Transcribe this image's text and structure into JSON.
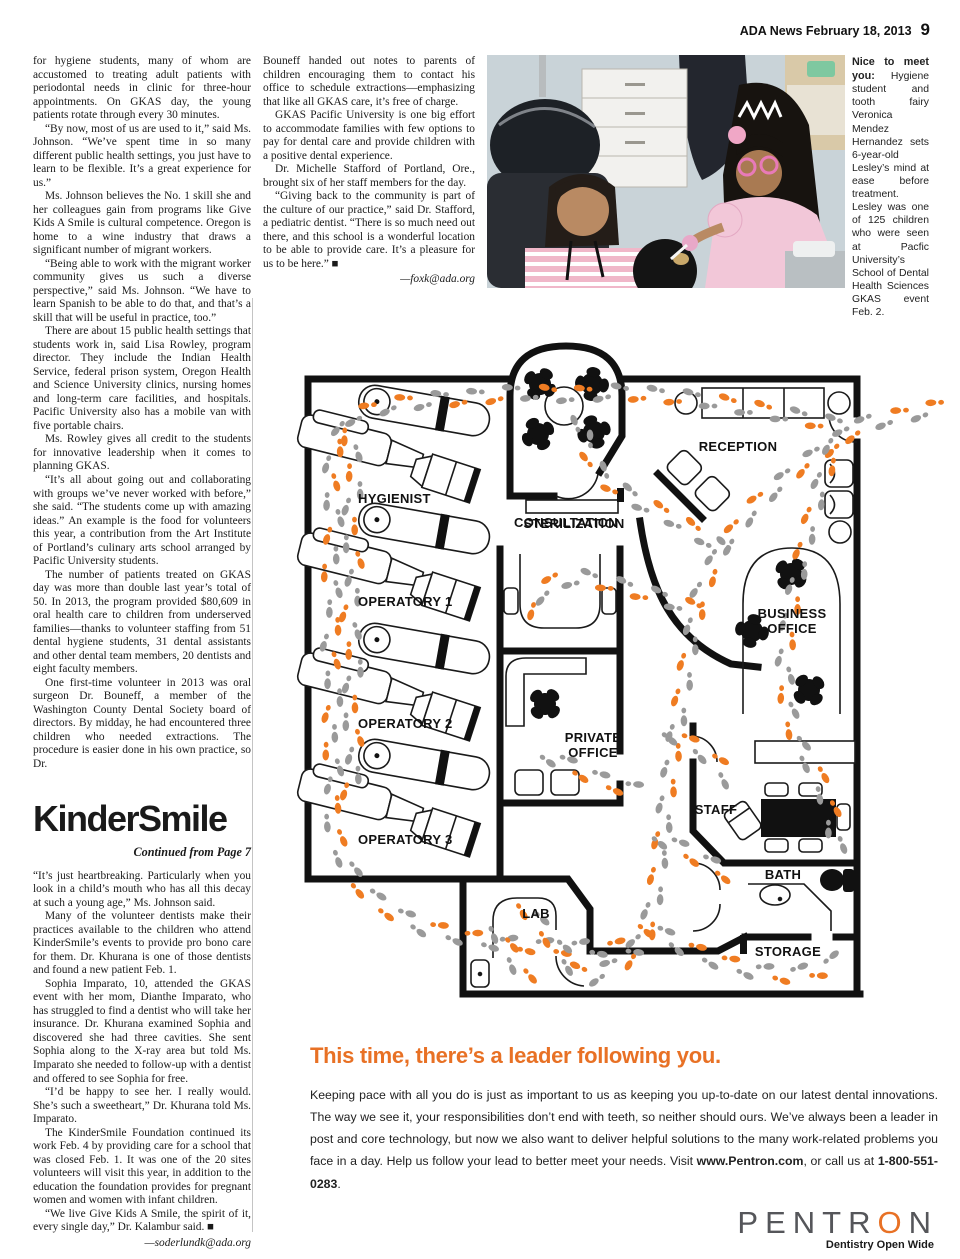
{
  "colors": {
    "accent_orange": "#E87125",
    "foot_orange": "#EF7C22",
    "foot_gray": "#9A9A9A",
    "logo_gray": "#55565A"
  },
  "header": {
    "masthead": "ADA News February 18, 2013",
    "page_number": "9"
  },
  "article": {
    "col1": [
      "for hygiene students, many of whom are accustomed to treating adult patients with periodontal needs in clinic for three-hour appointments. On GKAS day, the young patients rotate through every 30 minutes.",
      "“By now, most of us are used to it,” said Ms. Johnson. “We’ve spent time in so many different public health settings, you just have to learn to be flexible. It’s a great experience for us.”",
      "Ms. Johnson believes the No. 1 skill she and her colleagues gain from programs like Give Kids A Smile is cultural competence. Oregon is home to a wine industry that draws a significant number of migrant workers.",
      "“Being able to work with the migrant worker community gives us such a diverse perspective,” said Ms. Johnson. “We have to learn Spanish to be able to do that, and that’s a skill that will be useful in practice, too.”",
      "There are about 15 public health settings that students work in, said Lisa Rowley, program director. They include the Indian Health Service, federal prison system, Oregon Health and Science University clinics, nursing homes and long-term care facilities, and hospitals. Pacific University also has a mobile van with five portable chairs.",
      "Ms. Rowley gives all credit to the students for innovative leadership when it comes to planning GKAS.",
      "“It’s all about going out and collaborating with groups we’ve never worked with before,” she said. “The students come up with amazing ideas.” An example is the food for volunteers this year, a contribution from the Art Institute of Portland’s culinary arts school arranged by Pacific University students.",
      "The number of patients treated on GKAS day was more than double last year’s total of 50. In 2013, the program provided $80,609 in oral health care to children from underserved families—thanks to volunteer staffing from 51 dental hygiene students, 31 dental assistants and other dental team members, 20 dentists and eight faculty members.",
      "One first-time volunteer in 2013 was oral surgeon Dr. Bouneff, a member of the Washington County Dental Society board of directors. By midday, he had encountered three children who needed extractions. The procedure is easier done in his own practice, so Dr."
    ],
    "col2": [
      "Bouneff handed out notes to parents of children encouraging them to contact his office to schedule extractions—emphasizing that like all GKAS care, it’s free of charge.",
      "GKAS Pacific University is one big effort to accommodate families with few options to pay for dental care and provide children with a positive dental experience.",
      "Dr. Michelle Stafford of Portland, Ore., brought six of her staff members for the day.",
      "“Giving back to the community is part of the culture of our practice,” said Dr. Stafford, a pediatric dentist. “There is so much need out there, and this school is a wonderful location to be able to provide care. It’s a pleasure for us to be here.” ■"
    ],
    "col2_byline": "—foxk@ada.org"
  },
  "kindersmile": {
    "headline": "KinderSmile",
    "continued": "Continued from Page 7",
    "paras": [
      "“It’s just heartbreaking. Particularly when you look in a child’s mouth who has all this decay at such a young age,” Ms. Johnson said.",
      "Many of the volunteer dentists make their practices available to the children who attend KinderSmile’s events to provide pro bono care for them. Dr. Khurana is one of those dentists and found a new patient Feb. 1.",
      "Sophia Imparato, 10, attended the GKAS event with her mom, Dianthe Imparato, who has struggled to find a dentist who will take her insurance. Dr. Khurana examined Sophia and discovered she had three cavities. She sent Sophia along to the X-ray area but told Ms. Imparato she needed to follow-up with a dentist and offered to see Sophia for free.",
      "“I’d be happy to see her. I really would. She’s such a sweetheart,” Dr. Khurana told Ms. Imparato.",
      "The KinderSmile Foundation continued its work Feb. 4 by providing care for a school that was closed Feb. 1. It was one of the 20 sites volunteers will visit this year, in addition to the education the foundation provides for pregnant women and women with infant children.",
      "“We live Give Kids A Smile, the spirit of it, every single day,” Dr. Kalambur said. ■"
    ],
    "byline": "—soderlundk@ada.org"
  },
  "caption": {
    "lead": "Nice to meet you:",
    "text": "Hygiene student and tooth fairy Veronica Mendez Hernandez sets 6-year-old Lesley’s mind at ease before treatment. Lesley was one of 125 children who were seen at Pacfic University’s School of Dental Health Sciences GKAS event Feb. 2."
  },
  "floorplan": {
    "labels": {
      "hygienist": "HYGIENIST",
      "operatory1": "OPERATORY 1",
      "operatory2": "OPERATORY 2",
      "operatory3": "OPERATORY 3",
      "consultation": "CONSULTATION",
      "sterilization": "STERILIZATION",
      "reception": "RECEPTION",
      "business1": "BUSINESS",
      "business2": "OFFICE",
      "private1": "PRIVATE",
      "private2": "OFFICE",
      "staff": "STAFF",
      "bath": "BATH",
      "lab": "LAB",
      "storage": "STORAGE"
    }
  },
  "ad": {
    "headline": "This time, there’s a leader following you.",
    "body1": "Keeping pace with all you do is just as important to us as keeping you up-to-date on our latest dental innovations. The way we see it, your responsibilities don’t end with teeth, so neither should ours. We’ve always been a leader in post and core technology, but now we also want to deliver helpful solutions to the many work-related problems you face in a day. Help us follow your lead to better meet your needs. Visit ",
    "url": "www.Pentron.com",
    "body2": ", or call us at ",
    "phone": "1-800-551-0283",
    "body3": ".",
    "logo_pre": "PENTR",
    "logo_o": "O",
    "logo_post": "N",
    "tagline": "Dentistry Open Wide"
  }
}
